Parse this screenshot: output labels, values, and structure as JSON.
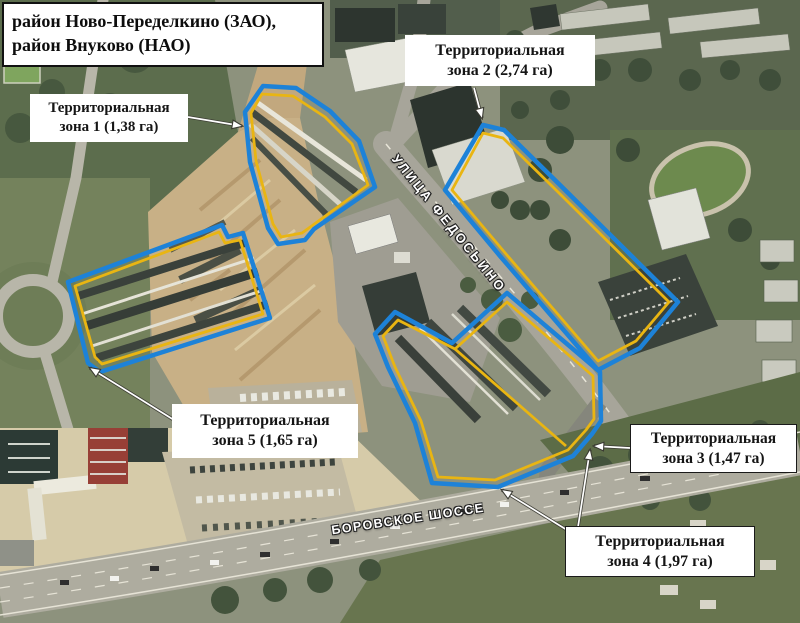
{
  "title": {
    "line1": "район Ново-Переделкино (ЗАО),",
    "line2": "район Внуково (НАО)"
  },
  "zone_labels": [
    {
      "line1": "Территориальная",
      "line2": "зона 1 (1,38 га)"
    },
    {
      "line1": "Территориальная",
      "line2": "зона 2 (2,74 га)"
    },
    {
      "line1": "Территориальная",
      "line2": "зона 3 (1,47 га)"
    },
    {
      "line1": "Территориальная",
      "line2": "зона 4 (1,97 га)"
    },
    {
      "line1": "Территориальная",
      "line2": "зона 5 (1,65 га)"
    }
  ],
  "street_labels": {
    "fedosino": "УЛИЦА ФЕДОСЬИНО",
    "borovskoe": "БОРОВСКОЕ ШОССЕ"
  },
  "colors": {
    "zone_outline_blue": "#1d82d8",
    "zone_outline_yellow": "#e9b512",
    "label_background": "#ffffff",
    "label_text": "#151515",
    "street_label_text": "#ffffff"
  }
}
